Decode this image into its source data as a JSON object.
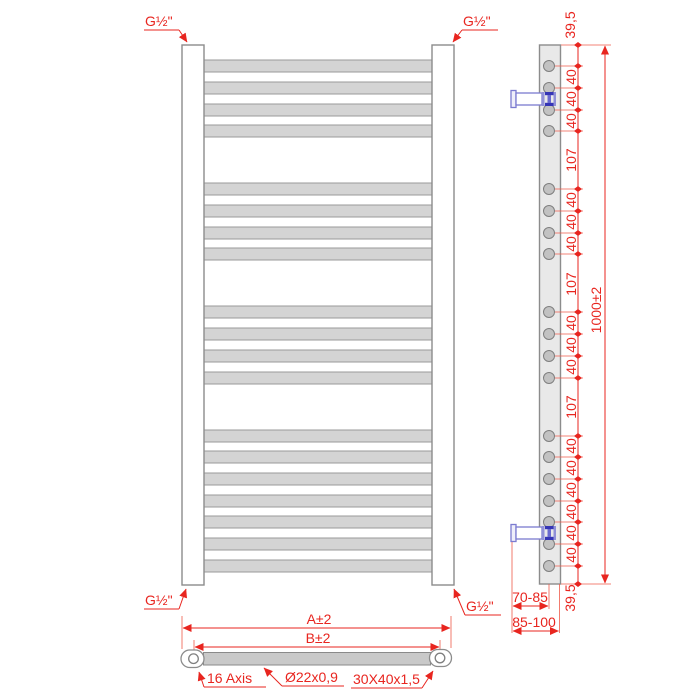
{
  "front_view": {
    "thread_labels": {
      "top_left": "G½\"",
      "top_right": "G½\"",
      "bottom_left": "G½\"",
      "bottom_right": "G½\""
    },
    "bar_count": 19,
    "bar_groups": [
      4,
      4,
      4,
      7
    ]
  },
  "side_view": {
    "dimensions": {
      "top_offset": "39,5",
      "bar_pitch": "40",
      "group_gap": "107",
      "overall_height": "1000±2",
      "bottom_offset": "39,5",
      "wall_to_axis_range": "70-85",
      "wall_to_back_range": "85-100"
    },
    "bar_pitch_label_count": 15,
    "group_gap_label_count": 3,
    "bracket_count": 2
  },
  "bottom_view": {
    "dimensions": {
      "overall_width": "A±2",
      "axis_to_axis_width": "B±2"
    },
    "callouts": {
      "axis_offset": "16 Axis",
      "bar_tube": "Ø22x0,9",
      "upright_profile": "30X40x1,5"
    }
  },
  "colors": {
    "dimension_red": "#e8251f",
    "bar_fill": "#d4d4d4",
    "outline_gray": "#8c8c8c",
    "bracket_blue": "#7b7bd0",
    "bracket_dark_blue": "#3535b5"
  }
}
